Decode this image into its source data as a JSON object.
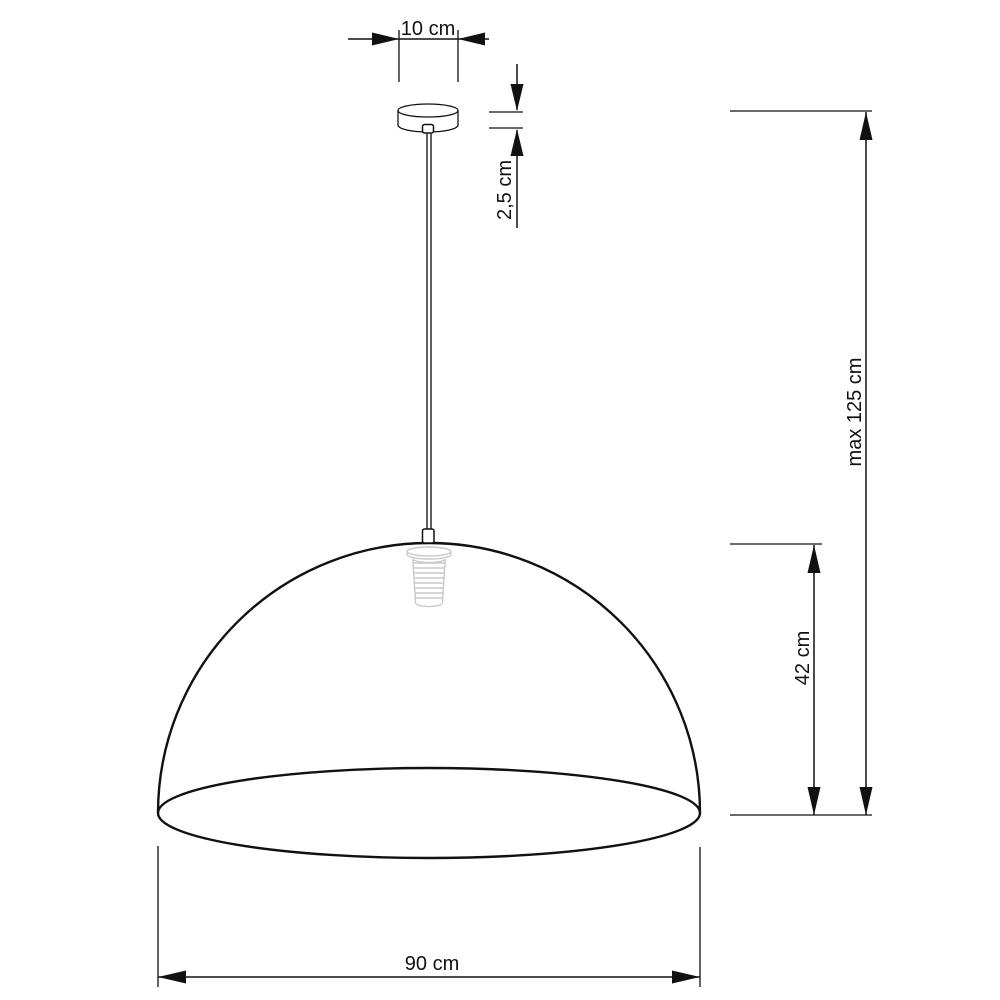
{
  "page": {
    "title": "Pendant lamp dimensional drawing",
    "background": "#ffffff"
  },
  "colors": {
    "line": "#111111",
    "socket_sketch": "#c9c9c9"
  },
  "dimensions": {
    "canopy_width": "10 cm",
    "canopy_height": "2,5 cm",
    "max_height": "max 125 cm",
    "shade_height": "42 cm",
    "shade_width": "90 cm"
  }
}
